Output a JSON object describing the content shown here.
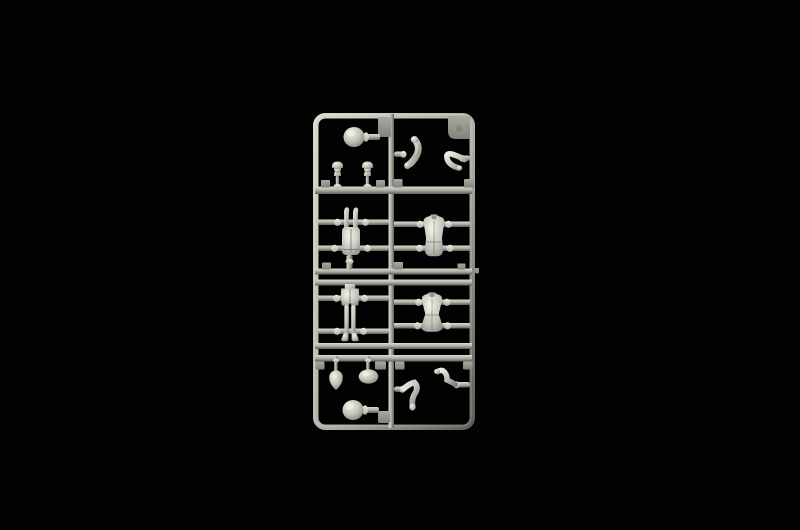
{
  "scene": {
    "description": "Photograph of a light-grey injection-moulded plastic model sprue with small-scale figure parts, centered on a black background",
    "sprue": {
      "material": "light grey polystyrene",
      "layout": "two columns, four rows of parts inside a rounded rectangular runner frame"
    },
    "parts": [
      {
        "name": "part-bare-head-top",
        "type": "head-ball",
        "x": 354,
        "y": 137
      },
      {
        "name": "part-capped-head-left",
        "type": "mini-head",
        "x": 337.5,
        "y": 187
      },
      {
        "name": "part-capped-head-right",
        "type": "mini-head",
        "x": 367.5,
        "y": 187
      },
      {
        "name": "part-curved-arm-upper",
        "type": "arm-banana",
        "x": 412,
        "y": 153
      },
      {
        "name": "part-bent-arm-upper",
        "type": "arm-bent-b",
        "x": 455,
        "y": 161
      },
      {
        "name": "part-legs-inverted",
        "type": "legs-up",
        "x": 351,
        "y": 231
      },
      {
        "name": "part-torso-upper",
        "type": "torso-a",
        "x": 434,
        "y": 236
      },
      {
        "name": "part-legs-upright",
        "type": "legs-down",
        "x": 350,
        "y": 313
      },
      {
        "name": "part-torso-lower",
        "type": "torso-b",
        "x": 432,
        "y": 313
      },
      {
        "name": "part-field-cap",
        "type": "pouch",
        "x": 336,
        "y": 356
      },
      {
        "name": "part-helmet",
        "type": "helmet",
        "x": 368,
        "y": 356
      },
      {
        "name": "part-bent-arm-lower-left",
        "type": "arm-bent-c",
        "x": 412,
        "y": 394
      },
      {
        "name": "part-bent-arm-lower-right",
        "type": "arm-bent-d",
        "x": 445,
        "y": 381
      },
      {
        "name": "part-bare-head-bottom",
        "type": "head-ball",
        "x": 353,
        "y": 410
      }
    ]
  },
  "colors": {
    "background": "#020202",
    "plastic_light": "#d7d7cd",
    "plastic_mid": "#aeaea4",
    "plastic_dark": "#5f5f58",
    "tab_mid": "#a9a9a0",
    "tab_dark": "#82827a",
    "part_highlight": "#efefe5",
    "part_mid": "#c2c2b8",
    "part_shadow": "#82827a"
  }
}
